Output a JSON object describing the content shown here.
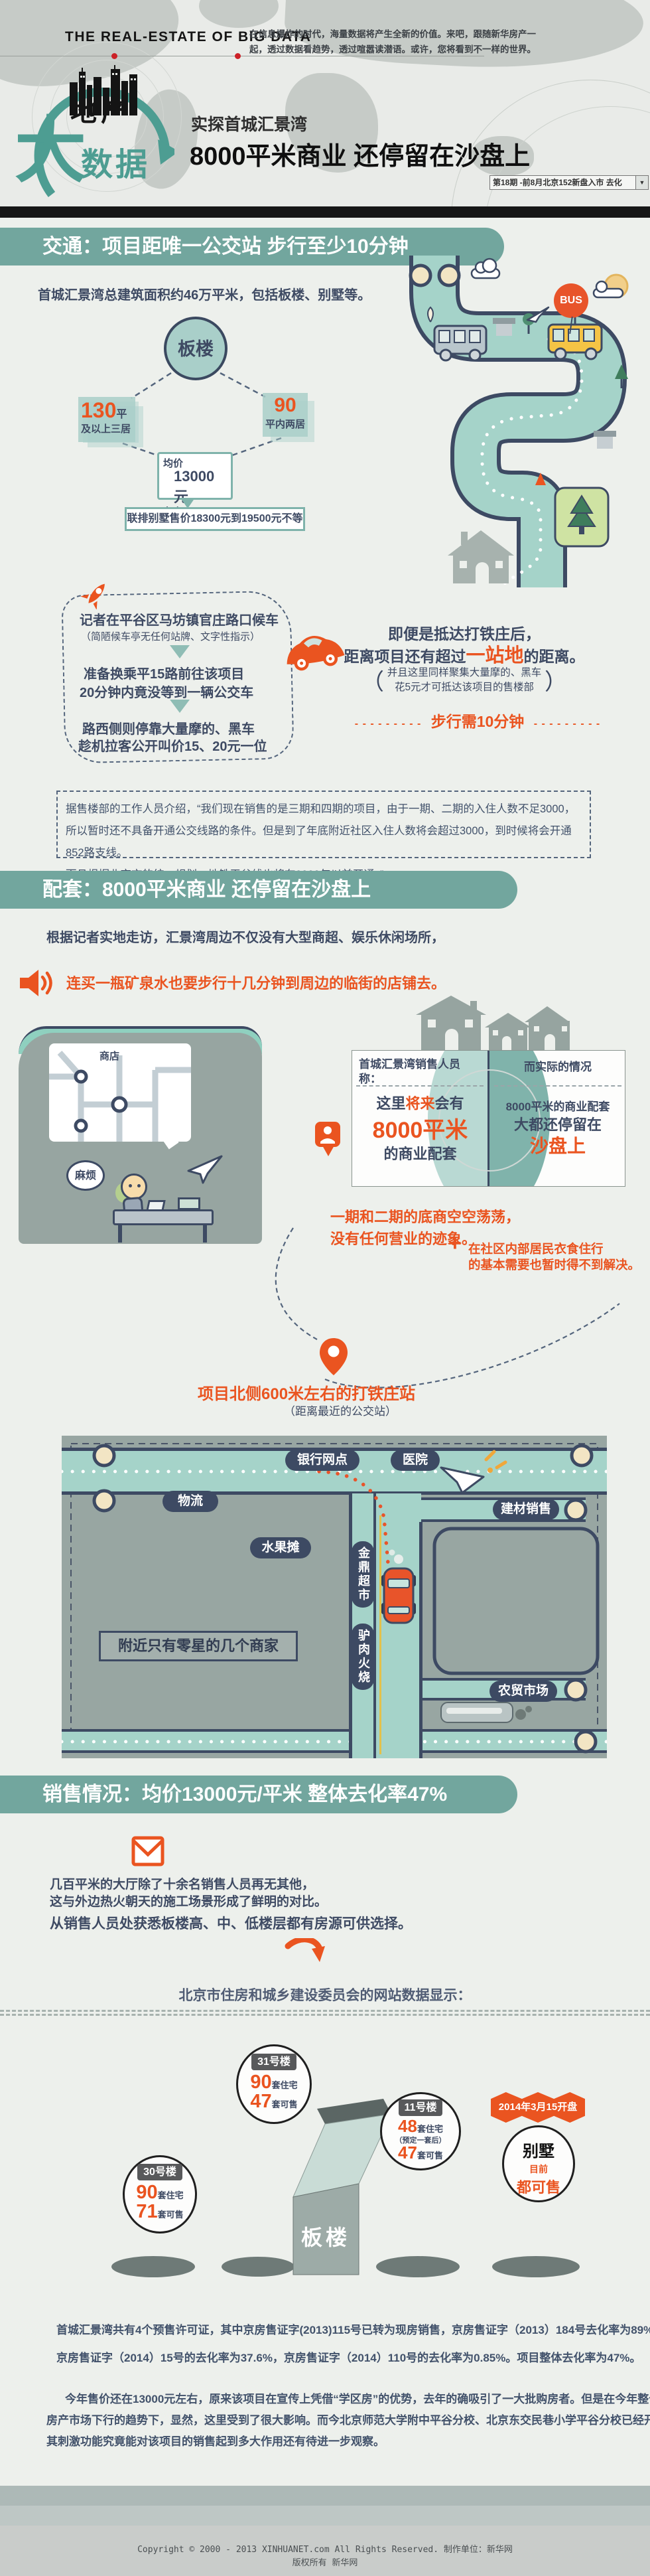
{
  "colors": {
    "teal": "#72a69e",
    "orange": "#ea5420",
    "navy": "#3e4a63",
    "logo_teal": "#4d9d92"
  },
  "header": {
    "title_en": "THE REAL-ESTATE OF BIG DATA",
    "intro_l1": "在信息爆炸的时代，海量数据将产生全新的价值。来吧，跟随新华房产一",
    "intro_l2": "起，透过数据看趋势，透过喧嚣读潜语。或许，您将看到不一样的世界。",
    "logo_land": "地产",
    "logo_big": "大",
    "logo_data": "数据",
    "subtitle": "实探首城汇景湾",
    "main_title": "8000平米商业 还停留在沙盘上",
    "issue_label": "第18期 -前8月北京152新盘入市 去化",
    "issue_arrow": "▼"
  },
  "traffic": {
    "banner": "交通：项目距唯一公交站 步行至少10分钟",
    "intro": "首城汇景湾总建筑面积约46万平米，包括板楼、别墅等。",
    "circle": "板楼",
    "t1_num": "130",
    "t1_unit": "平",
    "t1_desc": "及以上三居",
    "t2_num": "90",
    "t2_desc": "平内两居",
    "price_l1": "均价",
    "price_l2": "13000元",
    "price_l3": "左右",
    "villa_price": "联排别墅售价18300元到19500元不等",
    "bus": "BUS",
    "j1": "记者在平谷区马坊镇官庄路口候车",
    "j1n": "（简陋候车亭无任何站牌、文字性指示）",
    "j2a": "准备换乘平15路前往该项目",
    "j2b": "20分钟内竟没等到一辆公交车",
    "j3a": "路西侧则停靠大量摩的、黑车",
    "j3b": "趁机拉客公开叫价15、20元一位",
    "a1": "即便是抵达打铁庄后，",
    "a2_pre": "距离项目还有超过",
    "a2_hl": "一站地",
    "a2_post": "的距离。",
    "paren_l": "（",
    "paren_r": "）",
    "a_n1": "并且这里同样聚集大量摩的、黑车",
    "a_n2": "花5元才可抵达该项目的售楼部",
    "walk_dash": "- - - - - - - - -",
    "walk": "步行需10分钟",
    "q1": "据售楼部的工作人员介绍，“我们现在销售的是三期和四期的项目，由于一期、二期的入住人数不足3000，",
    "q2": "所以暂时还不具备开通公交线路的条件。但是到了年底附近社区入住人数将会超过3000，到时候将会开通852路支线。",
    "q3": "而且根据北京市的统一规划，地铁平谷线也将在2020年以前开通。”"
  },
  "facilities": {
    "banner": "配套：8000平米商业 还停留在沙盘上",
    "intro": "根据记者实地走访，汇景湾周边不仅没有大型商超、娱乐休闲场所，",
    "highlight": "连买一瓶矿泉水也要步行十几分钟到周边的临街的店铺去。",
    "shop": "商店",
    "trouble": "麻烦",
    "claim_t1": "首城汇景湾销售人员",
    "claim_t2": "称：",
    "claim_pre": "这里",
    "claim_hl": "将来",
    "claim_mid": "会有",
    "claim_big": "8000平米",
    "claim_post": "的商业配套",
    "fact_t": "而实际的情况",
    "fact_1": "8000平米的商业配套",
    "fact_2": "大都还停留在",
    "fact_hl": "沙盘上",
    "empty_1": "一期和二期的底商空空荡荡，",
    "empty_2": "没有任何营业的迹象。",
    "plus": "+",
    "need_1": "在社区内部居民衣食住行",
    "need_2": "的基本需要也暂时得不到解决。",
    "station": "项目北侧600米左右的打铁庄站",
    "station_note": "（距离最近的公交站）",
    "map": {
      "bank": "银行网点",
      "hospital": "医院",
      "logistics": "物流",
      "fruit": "水果摊",
      "supermarket": "金鼎超市",
      "donkey_shop": "驴肉火烧",
      "materials": "建材销售",
      "market": "农贸市场",
      "note": "附近只有零星的几个商家"
    }
  },
  "sales": {
    "banner": "销售情况：均价13000元/平米 整体去化率47%",
    "p1a": "几百平米的大厅除了十余名销售人员再无其他，",
    "p1b": "这与外边热火朝天的施工场景形成了鲜明的对比。",
    "p2": "从销售人员处获悉板楼高、中、低楼层都有房源可供选择。",
    "source": "北京市住房和城乡建设委员会的网站数据显示：",
    "b31": {
      "name": "31号楼",
      "n1": "90",
      "u1": "套住宅",
      "n2": "47",
      "u2": "套可售"
    },
    "b11": {
      "name": "11号楼",
      "n1": "48",
      "u1": "套住宅",
      "note": "（预定一套后）",
      "n2": "47",
      "u2": "套可售"
    },
    "b30": {
      "name": "30号楼",
      "n1": "90",
      "u1": "套住宅",
      "n2": "71",
      "u2": "套可售"
    },
    "villa": {
      "flag": "2014年3月15开盘",
      "name": "别墅",
      "s1": "目前",
      "s2": "都可售"
    },
    "tower": "板楼",
    "d1a": "首城汇景湾共有4个预售许可证，其中京房售证字(2013)115号已转为现房销售，京房售证字（2013）184号去化率为89%，",
    "d1b": "京房售证字（2014）15号的去化率为37.6%，京房售证字（2014）110号的去化率为0.85%。项目整体去化率为47%。",
    "d2a": "今年售价还在13000元左右，原来该项目在宣传上凭借“学区房”的优势，去年的确吸引了一大批购房者。但是在今年整个",
    "d2b": "房产市场下行的趋势下，显然，这里受到了很大影响。而今北京师范大学附中平谷分校、北京东交民巷小学平谷分校已经开学，",
    "d2c": "其刺激功能究竟能对该项目的销售起到多大作用还有待进一步观察。"
  },
  "footer": {
    "line1": "Copyright © 2000 - 2013 XINHUANET.com  All Rights Reserved.    制作单位：新华网",
    "line2": "版权所有 新华网"
  }
}
